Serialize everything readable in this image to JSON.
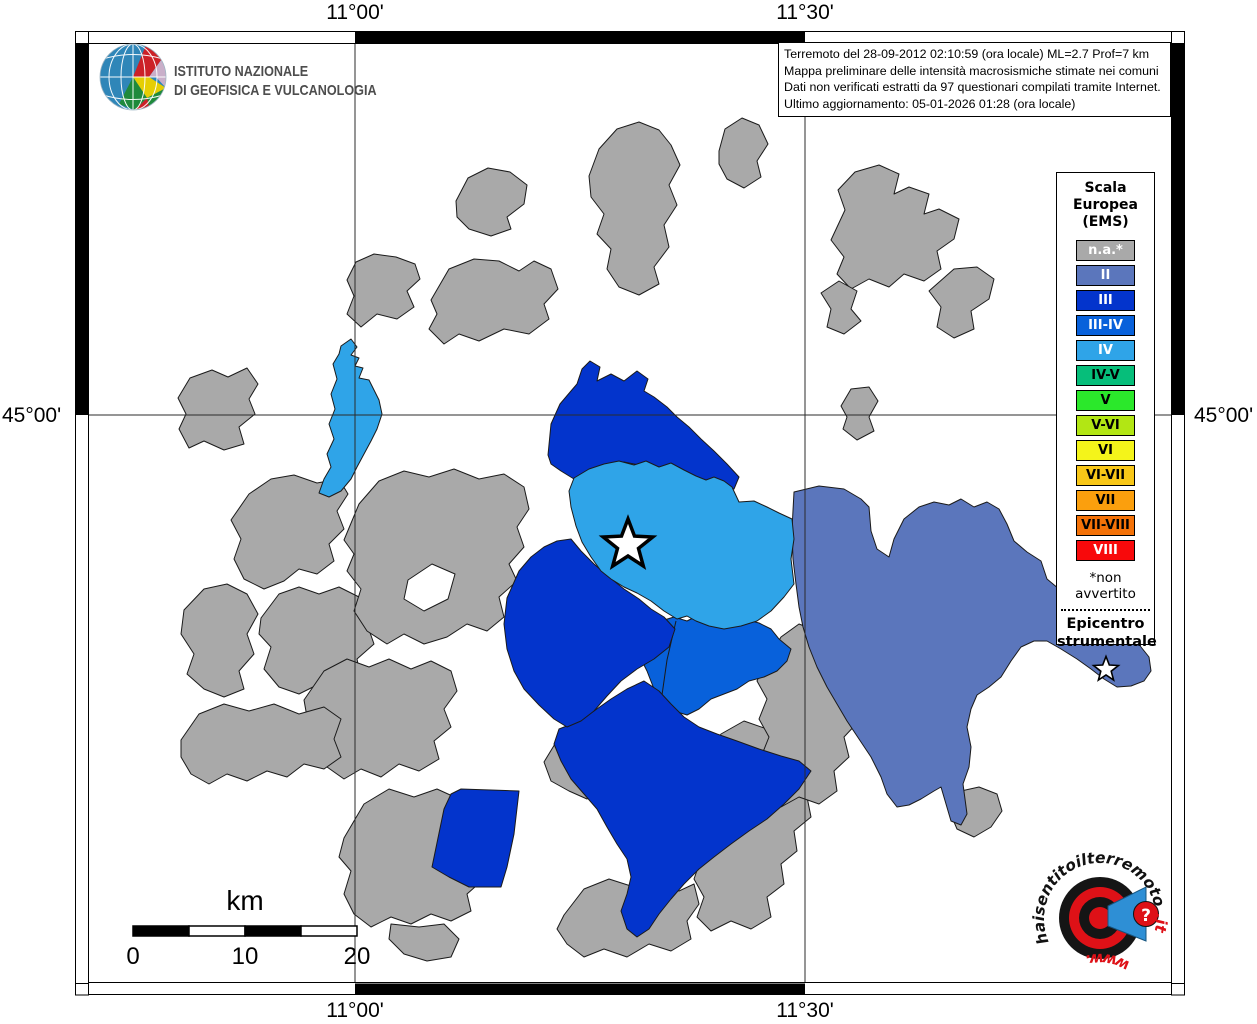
{
  "branding": {
    "institute_line1": "ISTITUTO NAZIONALE",
    "institute_line2": "DI GEOFISICA E VULCANOLOGIA"
  },
  "info_box": {
    "lines": [
      "Terremoto del 28-09-2012 02:10:59 (ora locale) ML=2.7 Prof=7 km",
      "Mappa preliminare delle intensità macrosismiche stimate nei comuni",
      "Dati non verificati estratti da 97 questionari compilati tramite Internet.",
      "Ultimo aggiornamento: 05-01-2026 01:28 (ora locale)"
    ]
  },
  "graticule": {
    "top_labels": [
      "11°00'",
      "11°30'"
    ],
    "bottom_labels": [
      "11°00'",
      "11°30'"
    ],
    "left_label": "45°00'",
    "right_label": "45°00'"
  },
  "legend": {
    "title": "Scala\nEuropea\n(EMS)",
    "items": [
      {
        "label": "n.a.*",
        "color": "#A9A9A9",
        "text_color": "#FFFFFF"
      },
      {
        "label": "II",
        "color": "#5B76BC",
        "text_color": "#FFFFFF"
      },
      {
        "label": "III",
        "color": "#0334CC",
        "text_color": "#FFFFFF"
      },
      {
        "label": "III-IV",
        "color": "#0861DB",
        "text_color": "#FFFFFF"
      },
      {
        "label": "IV",
        "color": "#2FA4E8",
        "text_color": "#FFFFFF"
      },
      {
        "label": "IV-V",
        "color": "#06BE7A",
        "text_color": "#000000"
      },
      {
        "label": "V",
        "color": "#2BE82B",
        "text_color": "#000000"
      },
      {
        "label": "V-VI",
        "color": "#B2E614",
        "text_color": "#000000"
      },
      {
        "label": "VI",
        "color": "#F4F41A",
        "text_color": "#000000"
      },
      {
        "label": "VI-VII",
        "color": "#F8C718",
        "text_color": "#000000"
      },
      {
        "label": "VII",
        "color": "#FB9F0D",
        "text_color": "#000000"
      },
      {
        "label": "VII-VIII",
        "color": "#F47208",
        "text_color": "#000000"
      },
      {
        "label": "VIII",
        "color": "#F8090B",
        "text_color": "#FFFFFF"
      }
    ],
    "footnote": "*non avvertito",
    "epicenter_label": "Epicentro\nstrumentale"
  },
  "scale_bar": {
    "unit": "km",
    "tick_labels": [
      "0",
      "10",
      "20"
    ]
  },
  "watermark": {
    "domain_black": "haisentitoilterremoto",
    "domain_suffix_red": ".it",
    "prefix_red": "www.",
    "question_mark": "?"
  },
  "palette": {
    "na": "#A9A9A9",
    "II": "#5B76BC",
    "III": "#0334CC",
    "III-IV": "#0861DB",
    "IV": "#2FA4E8",
    "map_border": "#1A1A1A",
    "accent_red": "#DE1117",
    "beam_blue": "#2E8FD5"
  },
  "map": {
    "intensities_shown": [
      "n.a.",
      "II",
      "III",
      "III-IV",
      "IV"
    ],
    "epicenter_symbol": "star"
  }
}
